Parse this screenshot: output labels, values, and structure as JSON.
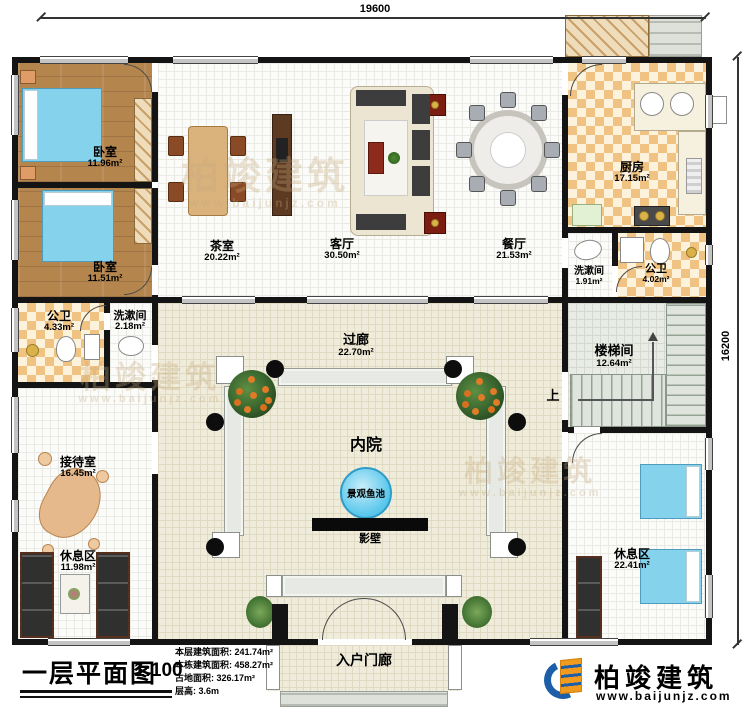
{
  "dimensions": {
    "width_label": "19600",
    "height_label": "16200"
  },
  "rooms": {
    "bedroom1": {
      "name": "卧室",
      "area": "11.96m²"
    },
    "bedroom2": {
      "name": "卧室",
      "area": "11.51m²"
    },
    "bath_left": {
      "name": "公卫",
      "area": "4.33m²"
    },
    "wash_left": {
      "name": "洗漱间",
      "area": "2.18m²"
    },
    "reception": {
      "name": "接待室",
      "area": "16.45m²"
    },
    "rest_left": {
      "name": "休息区",
      "area": "11.98m²"
    },
    "tea_room": {
      "name": "茶室",
      "area": "20.22m²"
    },
    "living": {
      "name": "客厅",
      "area": "30.50m²"
    },
    "dining": {
      "name": "餐厅",
      "area": "21.53m²"
    },
    "kitchen": {
      "name": "厨房",
      "area": "17.15m²"
    },
    "wash_right": {
      "name": "洗漱间",
      "area": "1.91m²"
    },
    "bath_right": {
      "name": "公卫",
      "area": "4.02m²"
    },
    "stairwell": {
      "name": "楼梯间",
      "area": "12.64m²"
    },
    "corridor": {
      "name": "过廊",
      "area": "22.70m²"
    },
    "courtyard": {
      "name": "内院"
    },
    "fish_pond": {
      "name": "景观鱼池"
    },
    "screen_wall": {
      "name": "影壁"
    },
    "rest_right": {
      "name": "休息区",
      "area": "22.41m²"
    },
    "entry_porch": {
      "name": "入户门廊"
    }
  },
  "stairs": {
    "up_label": "上"
  },
  "legend": {
    "title": "一层平面图",
    "scale": "1:100",
    "stats": [
      "本层建筑面积: 241.74m²",
      "本栋建筑面积: 458.27m²",
      "占地面积: 326.17m²",
      "层高: 3.6m"
    ]
  },
  "logo": {
    "name": "柏竣建筑",
    "url": "www.baijunjz.com"
  },
  "watermark": {
    "name": "柏竣建筑",
    "url": "www.baijunjz.com"
  },
  "colors": {
    "wall": "#141414",
    "wood_floor": "#b5854e",
    "checker_tile": "#f1c383",
    "courtyard_tile": "#f0ecdb",
    "pond_blue": "#5ec9ec",
    "bed_blue": "#85d2ec",
    "logo_blue": "#1c5fa8",
    "logo_orange": "#f09a1e"
  }
}
